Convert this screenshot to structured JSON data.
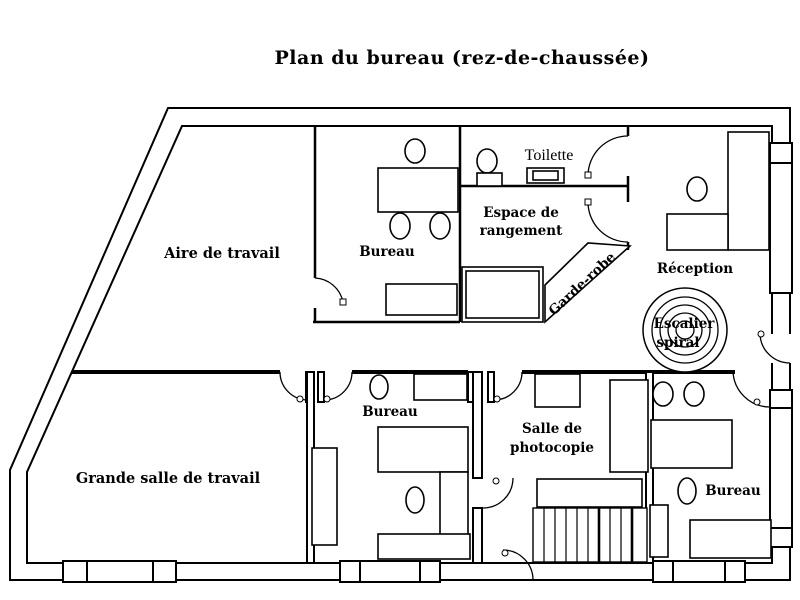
{
  "title": "Plan du bureau (rez-de-chaussée)",
  "colors": {
    "line": "#000000",
    "background": "#ffffff"
  },
  "rooms": {
    "aire": "Aire de travail",
    "bureau_top": "Bureau",
    "toilette": "Toilette",
    "rangement_l1": "Espace de",
    "rangement_l2": "rangement",
    "garde_robe": "Garde-robe",
    "reception": "Réception",
    "escalier_l1": "Escalier",
    "escalier_l2": "spiral",
    "grande_salle": "Grande salle de travail",
    "bureau_mid": "Bureau",
    "photocopie_l1": "Salle de",
    "photocopie_l2": "photocopie",
    "bureau_br": "Bureau"
  }
}
